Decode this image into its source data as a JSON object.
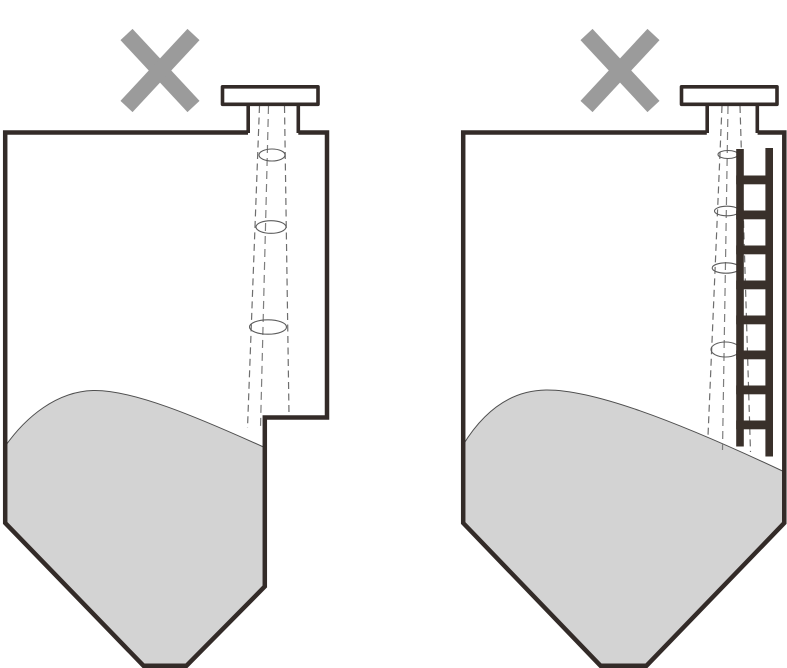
{
  "diagram": {
    "kind": "radar-level-sensor-incorrect-installation",
    "panels": [
      {
        "id": "left",
        "marker": "incorrect-cross",
        "obstruction": "stepped-tank-wall-ledge-in-beam-path",
        "components": [
          "radar-level-sensor",
          "mounting-flange",
          "tank-nozzle",
          "stepped-silo",
          "signal-beam",
          "bulk-material-heap"
        ],
        "beam_cross_sections": 3
      },
      {
        "id": "right",
        "marker": "incorrect-cross",
        "obstruction": "internal-ladder-in-beam-path",
        "components": [
          "radar-level-sensor",
          "mounting-flange",
          "tank-nozzle",
          "silo",
          "signal-beam",
          "internal-ladder",
          "bulk-material-heap"
        ],
        "beam_cross_sections": 4,
        "ladder_rungs": 8
      }
    ]
  },
  "colors": {
    "background": "#ffffff",
    "tank_wall": "#332b28",
    "device_outline": "#4a4340",
    "device_fill": "#ffffff",
    "beam_dash": "#6e6e6e",
    "beam_center_dash": "#7d7d7d",
    "cross_section_outline": "#5c5c5c",
    "material_fill": "#d3d3d3",
    "material_outline": "#4f4f4f",
    "ladder": "#39302a",
    "cross_mark": "#9b9b9b"
  }
}
